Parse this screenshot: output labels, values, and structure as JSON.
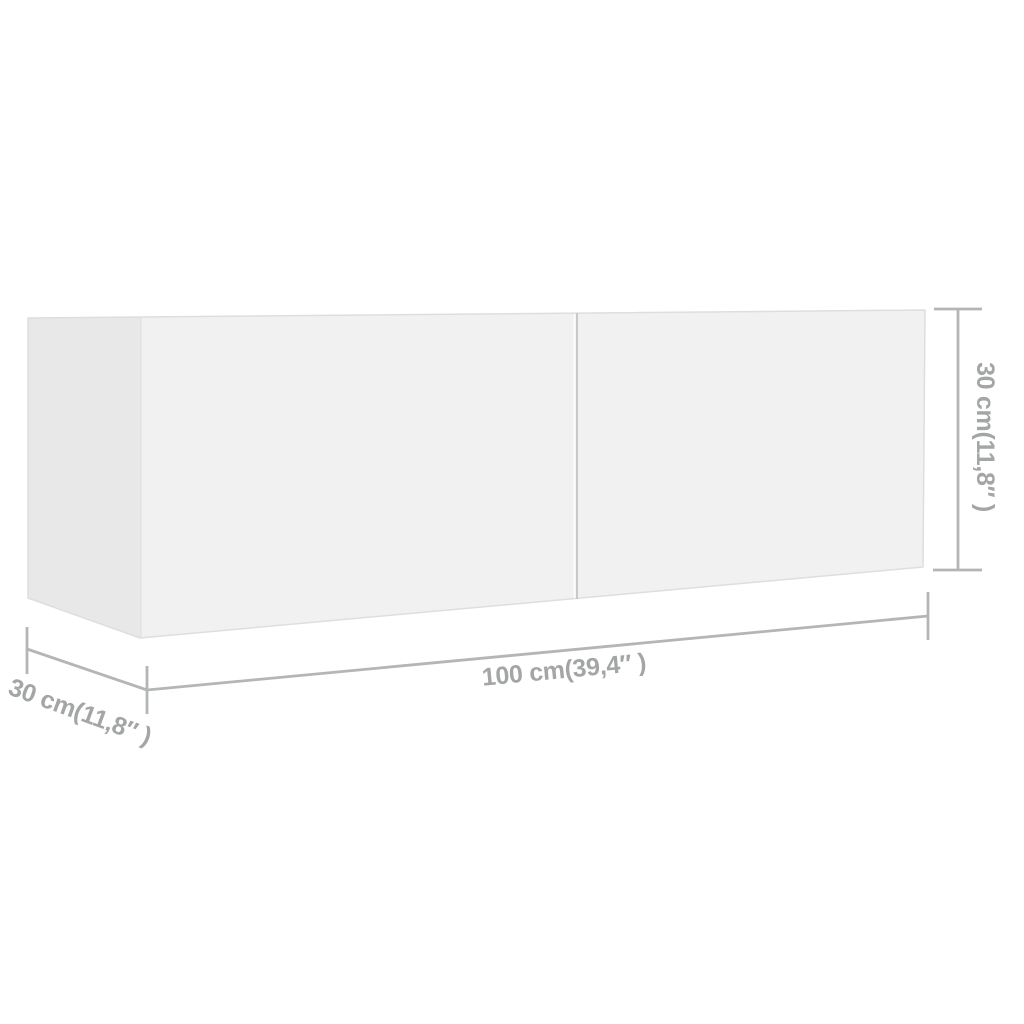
{
  "colors": {
    "background": "#ffffff",
    "front_face": "#f1f1f1",
    "side_face": "#e8e8e8",
    "edge_line": "#dedede",
    "divider_line": "#c9c9c9",
    "dimension_line": "#b4b6b6",
    "label_text": "#a4a6a6"
  },
  "dimensions": {
    "width": {
      "value": "100 cm",
      "imperial": "39,4″",
      "label": "100 cm(39,4″ )"
    },
    "depth": {
      "value": "30 cm",
      "imperial": "11,8″",
      "label": "30 cm(11,8″ )"
    },
    "height": {
      "value": "30 cm",
      "imperial": "11,8″",
      "label": "30 cm(11,8″ )"
    }
  }
}
